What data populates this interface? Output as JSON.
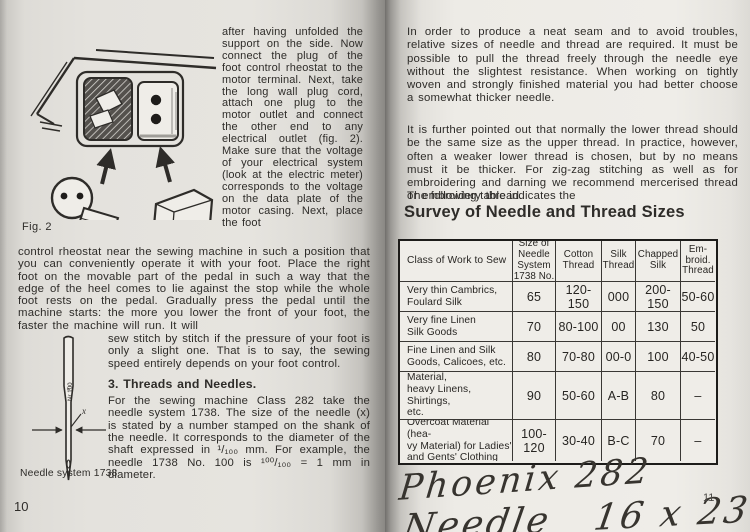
{
  "left_page": {
    "page_number": "10",
    "figure_caption": "Fig. 2",
    "column_text": "after having unfolded the support on the side. Now connect the plug of the foot control rheostat to the motor terminal. Next, take the long wall plug cord, attach one plug to the motor outlet and connect the other end to any electrical outlet (fig. 2). Make sure that the voltage of your electrical system (look at the electric meter) corresponds to the voltage on the data plate of the motor casing. Next, place the foot",
    "full_paragraph": "control rheostat near the sewing machine in such a position that you can conveniently operate it with your foot. Place the right foot on the movable part of the pedal in such a way that the edge of the heel comes to lie against the stop while the whole foot rests on the pedal. Gradually press the pedal until the machine starts: the more you lower the front of your foot, the faster the machine will run. It will",
    "needle_section": {
      "intro": "sew stitch by stitch if the pressure of your foot is only a slight one. That is to say, the sewing speed entirely depends on your foot control.",
      "heading": "3. Threads and Needles.",
      "body": "For the sewing machine Class 282 take the needle system 1738. The size of the needle (x) is stated by a number stamped on the shank of the needle. It corresponds to the diameter of the shaft expressed in ¹/₁₀₀ mm. For example, the needle 1738 No. 100 is ¹⁰⁰/₁₀₀ = 1 mm in diameter."
    },
    "needle_figure": {
      "shank_label": "Nr 100",
      "x_label": "x",
      "caption": "Needle system 1738"
    }
  },
  "right_page": {
    "page_number": "11",
    "paragraph1": "In order to produce a neat seam and to avoid troubles, relative sizes of needle and thread are required. It must be possible to pull the thread freely through the needle eye without the slightest resistance. When working on tightly woven and strongly finished material you had better choose a somewhat thicker needle.",
    "paragraph2": "It is further pointed out that normally the lower thread should be the same size as the upper thread. In practice, however, often a weaker lower thread is chosen, but by no means must it be thicker. For zig-zag stitching as well as for embroidering and darning we recommend mercerised thread or embroidery thread.",
    "table_intro": "The following table indicates the",
    "table_title": "Survey of Needle and Thread Sizes",
    "table": {
      "headers": [
        "Class of Work to Sew",
        "Size of\nNeedle\nSystem\n1738 No.",
        "Cotton\nThread",
        "Silk\nThread",
        "Chapped\nSilk",
        "Em-\nbroid.\nThread"
      ],
      "rows": [
        [
          "Very thin Cambrics,\nFoulard Silk",
          "65",
          "120-150",
          "000",
          "200-150",
          "50-60"
        ],
        [
          "Very fine Linen\nSilk Goods",
          "70",
          "80-100",
          "00",
          "130",
          "50"
        ],
        [
          "Fine Linen and Silk\nGoods, Calicoes, etc.",
          "80",
          "70-80",
          "00-0",
          "100",
          "40-50"
        ],
        [
          "Ladies' Dress Material,\nheavy Linens, Shirtings,\netc.\nfine Leather",
          "90",
          "50-60",
          "A-B",
          "80",
          "–"
        ],
        [
          "Overcoat Material (hea-\nvy Material) for Ladies'\nand Gents' Clothing",
          "100-120",
          "30-40",
          "B-C",
          "70",
          "–"
        ]
      ]
    },
    "handwriting_line1": "Phoenix 282",
    "handwriting_line2": "Needle   16 x 231"
  },
  "colors": {
    "paper": "#eae8e3",
    "ink": "#2e2c29",
    "table_border": "#1d1c1a",
    "handwriting_ink": "#37342f"
  }
}
